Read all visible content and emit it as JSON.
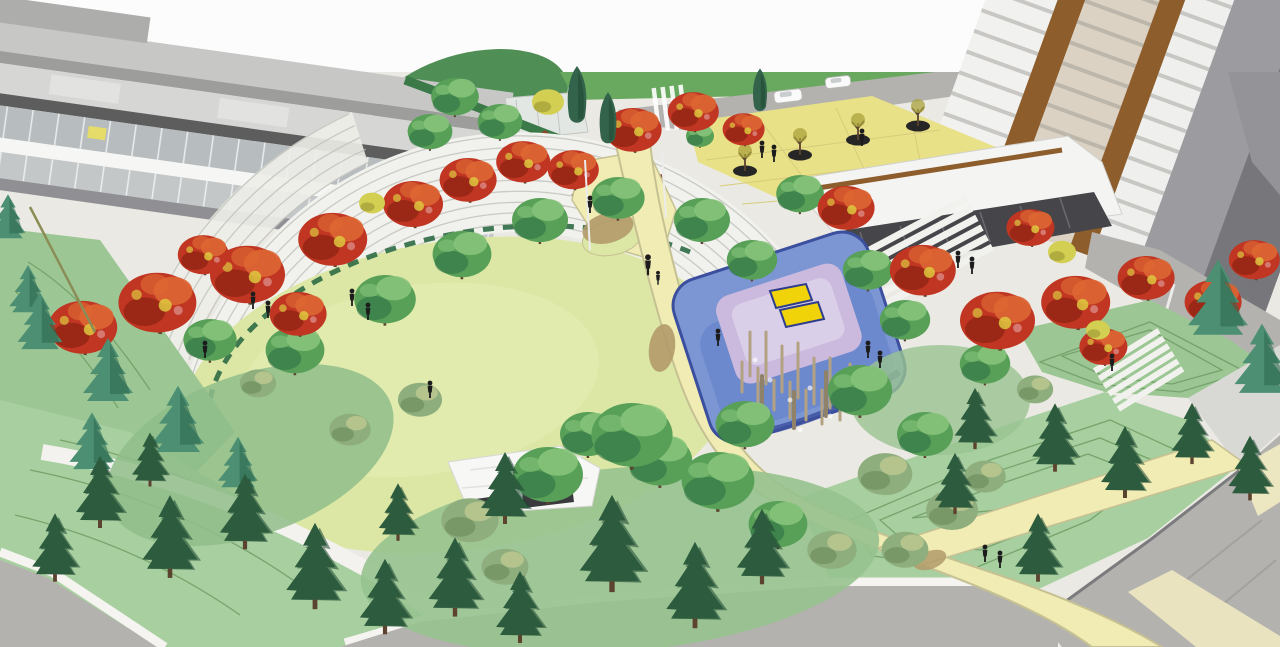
{
  "image": {
    "kind": "architectural landscape rendering",
    "description": "Aerial artist rendering of an urban park: a central oval lawn ringed by white terraced amphitheater steps and red autumn trees, a blue and lavender splash-pad playground with a yellow canopy and timber play poles, curving cream pathways, evergreen groves on the lower slopes, a low grey glass building at the upper left, and a white residential tower with wood accent stripes at the upper right, bordered by grey streets.",
    "width_px": 1280,
    "height_px": 647
  },
  "scene": {
    "landmarks": [
      "left office building",
      "residential tower",
      "entry plaza",
      "street with cars",
      "amphitheater steps",
      "great lawn",
      "splash pad playground",
      "yellow canopy structure",
      "main pathway",
      "path crossing",
      "picnic pavilion",
      "evergreen grove",
      "terraced banks",
      "perimeter roads"
    ]
  },
  "palette": {
    "white_band": "#fcfcfc",
    "base": "#ebe9e3",
    "road": "#b4b2af",
    "road_stripe": "#a3a19e",
    "curb": "#f5f4f0",
    "sidewalk": "#f3f2ee",
    "steps": "#f1f1ed",
    "steps_line": "#c0c0ba",
    "bldg_roof1": "#c7c7c5",
    "bldg_roof2": "#d6d6d4",
    "bldg_band_dark": "#5d5d5e",
    "bldg_gray": "#9d9d9b",
    "bldg_glass": "#b7bcbe",
    "bldg_glass2": "#c3c7c8",
    "bldg_white": "#f6f6f4",
    "bldg_base": "#909094",
    "sign_yellow": "#e5dc6a",
    "tower_white": "#f1f1ef",
    "tower_white2": "#eff0ee",
    "tower_beige": "#dbd2c3",
    "tower_wood": "#8d5d2c",
    "tower_gray": "#9c9ca0",
    "tower_dark": "#77777b",
    "podium_white": "#f4f4f2",
    "storefront": "#45454a",
    "wall_wedge": "#8e8e90",
    "wedge_light": "#d8d8d5",
    "block_gray": "#939398",
    "lawn": "#dce7a5",
    "lawn_light": "#e6eeb6",
    "grass_mid": "#69a85f",
    "grass_under": "#96c28e",
    "grass_dark": "#4f8f55",
    "bank": "#a7cf9f",
    "bank2": "#9cc794",
    "contour": "#6f9c64",
    "hedge": "#2e6a45",
    "roofhedge": "#3b7a48",
    "plaza": "#e9e187",
    "plaza_line": "#d6cc7c",
    "path": "#f0ecb3",
    "path_edge": "#c6c193",
    "path_pale": "#ece7c0",
    "tan": "#b29a6a",
    "tree_red": "#c03622",
    "tree_crimson": "#8f2313",
    "tree_orange": "#dd6633",
    "tree_gold": "#ddc83e",
    "tree_pink": "#d98a84",
    "tree_green": "#58a057",
    "tree_green_light": "#86c37a",
    "tree_green_dark": "#2f7246",
    "tree_sage": "#8fae7e",
    "tree_sage_dark": "#6d8f60",
    "tree_sage_light": "#b9c68f",
    "tree_yellow": "#d3cf52",
    "tree_yellow_dark": "#a8a23c",
    "fir": "#2c5b3d",
    "fir_dark": "#1d4530",
    "fir_teal": "#4c8f72",
    "fir_teal_dark": "#2e6b52",
    "cypress": "#33634a",
    "trunk": "#5c4330",
    "pg_blue": "#7b96d3",
    "pg_blue_mid": "#6d89cd",
    "pg_blue_dark": "#3c4f9e",
    "pg_lav": "#cbbade",
    "pg_lav_light": "#dacfe8",
    "canopy": "#f0d308",
    "canopy_edge": "#2e3e8c",
    "pole": "#b2a282",
    "person": "#1c1c1c",
    "car": "#fafafa",
    "car_glass": "#c9cdce",
    "glass_struct": "#e3e7e3",
    "lamp": "#8b8d57",
    "pole_white": "#ececec",
    "planter": "#262626"
  }
}
